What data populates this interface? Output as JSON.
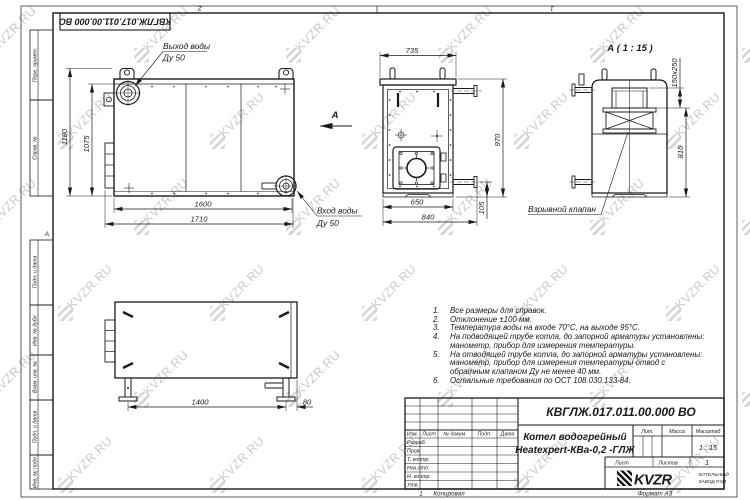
{
  "page": {
    "designation_flipped": "КВГЛЖ.017.011.00.000 ВО",
    "zone_top_left": "2",
    "zone_top_right": "1",
    "zone_left": "А",
    "zone_bottom": "1",
    "copied_label": "Копировал",
    "format_label": "Формат А3"
  },
  "watermark": {
    "text": "KVZR.RU"
  },
  "margin_boxes": [
    "Перв. примен.",
    "Справ. №",
    "Подп. и дата",
    "Инв. № дубл.",
    "Взам. инв. №",
    "Подп. и дата",
    "Инв. № подл."
  ],
  "views": {
    "front": {
      "outlet_label": "Выход воды",
      "outlet_dn": "Ду 50",
      "inlet_label": "Вход воды",
      "inlet_dn": "Ду 50",
      "view_arrow_label": "А",
      "dims": {
        "height_overall": "1180",
        "height_body": "1075",
        "width_body": "1600",
        "width_overall": "1710"
      }
    },
    "side": {
      "dims": {
        "width_top": "735",
        "height": "970",
        "width_bottom": "650",
        "depth_overall": "840",
        "pipe_height": "105"
      }
    },
    "back": {
      "title": "А ( 1 : 15 )",
      "valve_label": "Взрывной клапан",
      "dims": {
        "flue_opening": "150x250",
        "height": "810"
      }
    },
    "top": {
      "dims": {
        "legs_span": "1400",
        "leg_offset": "80"
      }
    }
  },
  "notes": {
    "items": [
      {
        "n": "1.",
        "text": "Все размеры для справок."
      },
      {
        "n": "2.",
        "text": "Отклонение ±100 мм."
      },
      {
        "n": "3.",
        "text": "Температура воды на входе 70°С, на выходе 95°С."
      },
      {
        "n": "4.",
        "text": "На подводящей трубе котла, до запорной арматуры установлены: манометр, прибор для измерения температуры."
      },
      {
        "n": "5.",
        "text": "На отводящей трубе котла, до запорной арматуры установлены: манометр, прибор для измерения температуры  отвод с обратным клапаном Ду не менее 40 мм."
      },
      {
        "n": "6.",
        "text": "Остальные требования по ОСТ 108.030.133-84."
      }
    ]
  },
  "title_block": {
    "designation": "КВГЛЖ.017.011.00.000 ВО",
    "product_name_line1": "Котел водогрейный",
    "product_name_line2": "Heatexpert-КВа-0,2 -ГЛЖ",
    "col_izm": "Изм.",
    "col_list": "Лист",
    "col_doc": "№ докум.",
    "col_sign": "Подп.",
    "col_date": "Дата",
    "rows": [
      "Разраб.",
      "Пров.",
      "Т. контр.",
      "Нач.отд.",
      "Н. контр.",
      "Утв."
    ],
    "lit_label": "Лит.",
    "mass_label": "Масса",
    "scale_label": "Масштаб",
    "scale_value": "1 : 15",
    "sheet_label": "Лист",
    "sheets_label": "Листов",
    "sheets_value": "1",
    "logo_text": "KVZR",
    "logo_sub1": "КОТЕЛЬНЫЙ",
    "logo_sub2": "ЗАВОД РЭП"
  }
}
